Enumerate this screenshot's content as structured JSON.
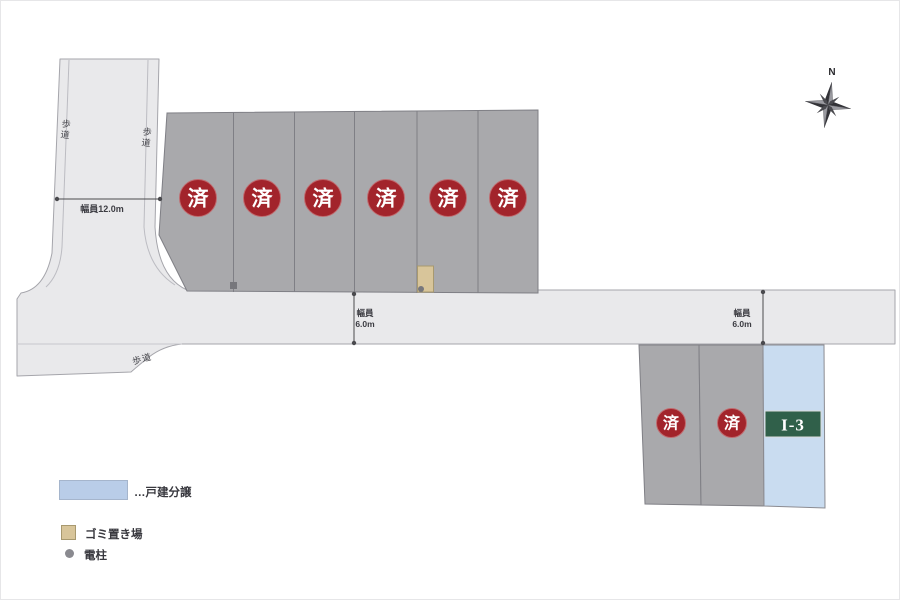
{
  "compass": {
    "north_label": "N"
  },
  "roads": {
    "vertical": {
      "sidewalk_label_left": "歩道",
      "sidewalk_label_right": "歩道",
      "width_label": "幅員12.0m"
    },
    "horizontal": {
      "width_label_1_line1": "幅員",
      "width_label_1_line2": "6.0m",
      "width_label_2_line1": "幅員",
      "width_label_2_line2": "6.0m",
      "sidewalk_label": "歩道"
    }
  },
  "lots": {
    "top_row": [
      {
        "status": "済"
      },
      {
        "status": "済"
      },
      {
        "status": "済"
      },
      {
        "status": "済"
      },
      {
        "status": "済"
      },
      {
        "status": "済"
      }
    ],
    "bottom_row": [
      {
        "status": "済"
      },
      {
        "status": "済"
      }
    ],
    "featured": {
      "label": "I-3"
    }
  },
  "legend": {
    "detached_house": "…戸建分譲",
    "garbage_area": "ゴミ置き場",
    "utility_pole": "電柱"
  },
  "colors": {
    "road": "#e9e9eb",
    "lot_sold": "#a9a9ac",
    "lot_available": "#c9dcf0",
    "sold_badge": "#a2242b",
    "featured_badge": "#30604a",
    "garbage": "#d8c59a"
  }
}
